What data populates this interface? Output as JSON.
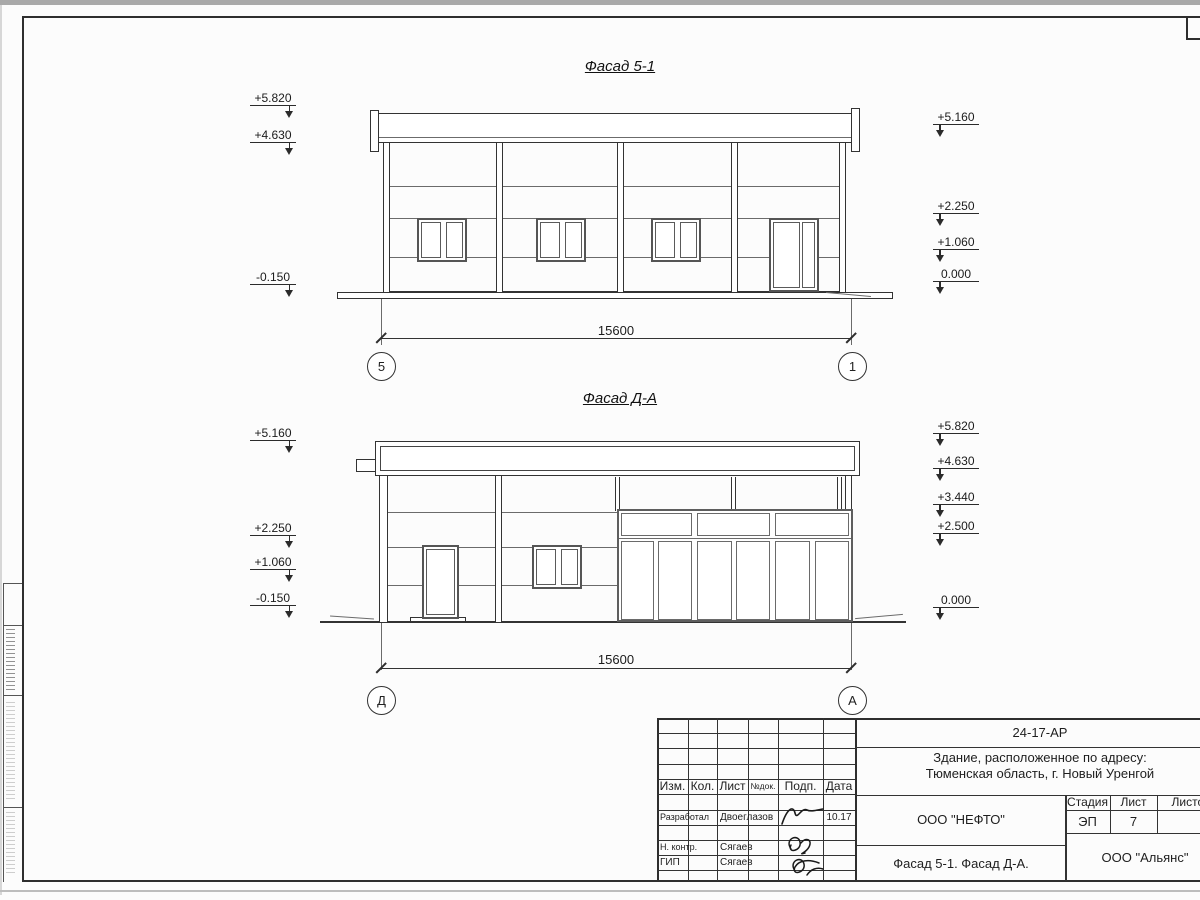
{
  "f1": {
    "title": "Фасад 5-1",
    "dimension": "15600",
    "axis_left": "5",
    "axis_right": "1",
    "left_marks": [
      "+5.820",
      "+4.630",
      "-0.150"
    ],
    "right_marks": [
      "+5.160",
      "+2.250",
      "+1.060",
      "0.000"
    ]
  },
  "f2": {
    "title": "Фасад Д-А",
    "dimension": "15600",
    "axis_left": "Д",
    "axis_right": "А",
    "left_marks": [
      "+5.160",
      "+2.250",
      "+1.060",
      "-0.150"
    ],
    "right_marks": [
      "+5.820",
      "+4.630",
      "+3.440",
      "+2.500",
      "0.000"
    ]
  },
  "titleblock": {
    "doc_code": "24-17-АР",
    "project_line1": "Здание, расположенное по адресу:",
    "project_line2": "Тюменская область, г. Новый Уренгой",
    "org": "ООО \"НЕФТО\"",
    "sheet_name": "Фасад 5-1. Фасад Д-А.",
    "contractor": "ООО \"Альянс\"",
    "col_izm": "Изм.",
    "col_kol": "Кол.",
    "col_list": "Лист",
    "col_ndok": "№док.",
    "col_podp": "Подп.",
    "col_data": "Дата",
    "stage_header": "Стадия",
    "sheet_header": "Лист",
    "sheets_header": "Листов",
    "stage": "ЭП",
    "sheet_no": "7",
    "row1_role": "Разработал",
    "row1_name": "Двоеглазов",
    "row1_date": "10.17",
    "row2_role": "Н. контр.",
    "row2_name": "Сягаев",
    "row3_role": "ГИП",
    "row3_name": "Сягаев"
  }
}
